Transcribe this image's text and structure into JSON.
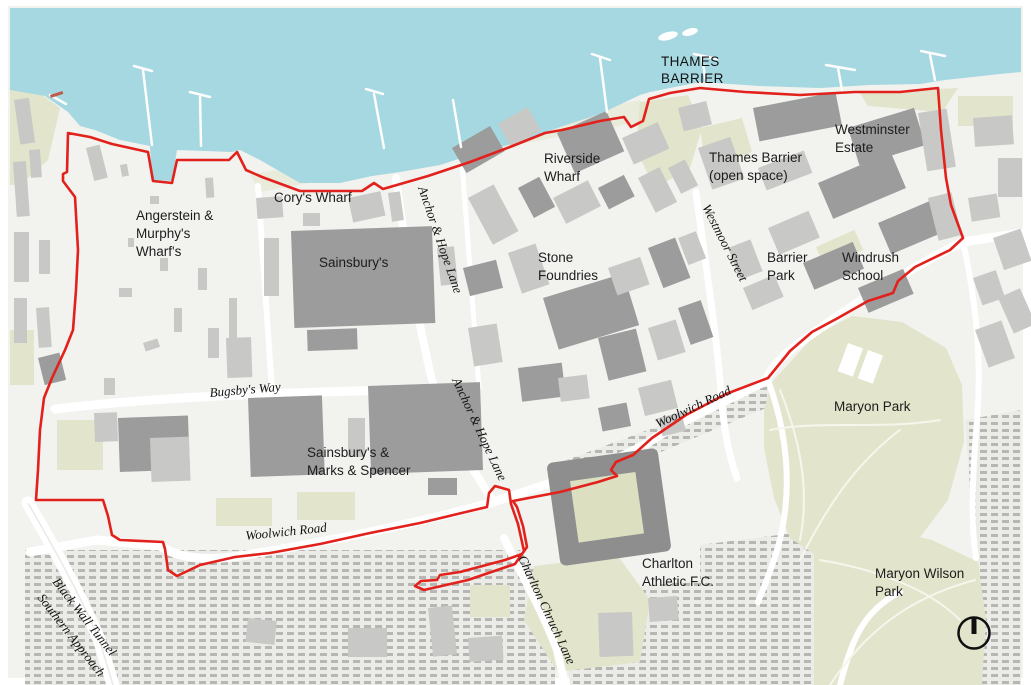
{
  "map_labels": {
    "thames_barrier_line1": "THAMES",
    "thames_barrier_line2": "BARRIER",
    "westminster_estate_line1": "Westminster",
    "westminster_estate_line2": "Estate",
    "riverside_wharf_line1": "Riverside",
    "riverside_wharf_line2": "Wharf",
    "thames_barrier_open_line1": "Thames Barrier",
    "thames_barrier_open_line2": "(open space)",
    "corys_wharf": "Cory's Wharf",
    "angerstein_line1": "Angerstein &",
    "angerstein_line2": "Murphy's",
    "angerstein_line3": "Wharf's",
    "sainsburys": "Sainsbury's",
    "stone_foundries_line1": "Stone",
    "stone_foundries_line2": "Foundries",
    "barrier_park_line1": "Barrier",
    "barrier_park_line2": "Park",
    "windrush_school_line1": "Windrush",
    "windrush_school_line2": "School",
    "westmoor_street": "Westmoor Street",
    "anchor_hope_lane_north": "Anchor & Hope Lane",
    "anchor_hope_lane_south": "Anchor & Hope Lane",
    "bugsbys_way": "Bugsby's Way",
    "woolwich_road_west": "Woolwich Road",
    "woolwich_road_east": "Woolwich Road",
    "maryon_park": "Maryon Park",
    "sainsburys_ms_line1": "Sainsbury's &",
    "sainsburys_ms_line2": "Marks & Spencer",
    "charlton_fc_line1": "Charlton",
    "charlton_fc_line2": "Athletic F.C.",
    "maryon_wilson_line1": "Maryon Wilson",
    "maryon_wilson_line2": "Park",
    "blackwall_line1": "Black Wall Tunnel",
    "blackwall_line2": "Southern Approach",
    "charlton_church_lane": "Charlton Chruch Lane"
  },
  "colors": {
    "water": "#a6d8e1",
    "boundary_red": "#e2211c",
    "park_green": "#e2e5cb",
    "building_dark": "#9c9c9c",
    "building_light": "#c8c8c6",
    "land": "#f2f2ef",
    "label_text": "#1c1c1c"
  },
  "icons": {
    "compass": "north-compass"
  }
}
